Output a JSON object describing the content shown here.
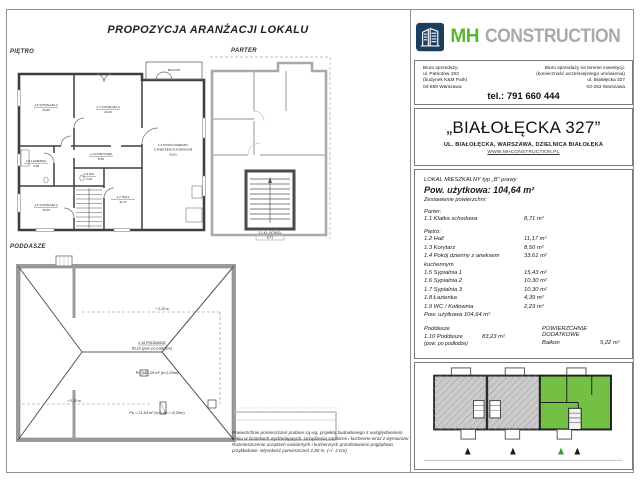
{
  "left": {
    "title": "PROPOZYCJA ARANŻACJI LOKALU",
    "labels": {
      "pietro": "PIĘTRO",
      "parter": "PARTER",
      "poddasze": "PODDASZE"
    },
    "pietro": {
      "balkon": "BALKON",
      "rooms": {
        "syp2": {
          "name": "1.6 SYPIALNIA 2",
          "area": "10,30"
        },
        "syp3": {
          "name": "1.7 SYPIALNIA 3",
          "area": "10,30"
        },
        "living1": "1.4 POKÓJ DZIENNY",
        "living2": "Z ANEKSEM KUCHENNYM",
        "living_area": "33,61",
        "lazienka": {
          "name": "1.8 ŁAZIENKA",
          "area": "4,39"
        },
        "wc": {
          "name": "1.9 WC",
          "area": "2,23"
        },
        "korytarz": {
          "name": "1.3 KORYTARZ",
          "area": "8,50"
        },
        "syp1": {
          "name": "1.5 SYPIALNIA 1",
          "area": "15,43"
        },
        "hall": {
          "name": "1.2 HALL",
          "area": "11,17"
        }
      }
    },
    "parter": {
      "stairs_name": "1.1 KL. SCHOD.",
      "stairs_area": "8,71"
    },
    "poddasze": {
      "name": "1.10 PODDASZE",
      "area": "83,23 (pow. po podłodze)",
      "pu_high": "Pu = 61,29 m² (h>2,20m)",
      "pu_low": "Pu = 21,94 m² (h>1,40 / <2,20m)",
      "height_mark1": "+ 2,20 m",
      "height_mark2": "+ 2,20 m"
    },
    "disclaimer": {
      "l1": "Powierzchnie pomieszczeń podane są wg. projektu budowlanego z uwzględnieniem",
      "l2": "tynku w ściankach wydzielających. Urządzenia sanitarne i kuchenne wraz z wymiarami",
      "l3": "Rozmieszczenie urządzeń sanitarnych i kuchennych przedstawiono poglądowo",
      "l4": "przykładowe. Wysokość pomieszczeń 2,80 m. (+/- 2 cm)"
    }
  },
  "right": {
    "logo": {
      "mh": "MH",
      "construction": "CONSTRUCTION"
    },
    "contact": {
      "office_left": {
        "l1": "Biuro sprzedaży:",
        "l2": "ul. Patriotów 193",
        "l3": "(budynek K&M Park)",
        "l4": "04-858 Warszawa"
      },
      "office_right": {
        "l1": "Biuro sprzedaży na terenie inwestycji:",
        "l2": "(konieczność wcześniejszego umówienia)",
        "l3": "ul. Białołęcka 327",
        "l4": "03-253 Warszawa"
      },
      "phone": "tel.: 791 660 444"
    },
    "title_block": {
      "name": "„BIAŁOŁĘCKA 327”",
      "address": "UL. BIAŁOŁĘCKA, WARSZAWA, DZIELNICA BIAŁOŁĘKA",
      "website": "WWW.MHCONSTRUCTION.PL"
    },
    "details": {
      "type_line": "LOKAL MIESZKALNY typ „B” prawy",
      "area_line": "Pow. użytkowa: 104,64 m²",
      "summary_line": "Zestawienie powierzchni:",
      "parter_header": "Parter:",
      "parter_rooms": [
        {
          "label": "1.1 Klatka schodowa",
          "area": "8,71 m²"
        }
      ],
      "pietro_header": "Piętro:",
      "pietro_rooms": [
        {
          "label": "1.2 Hall",
          "area": "11,17 m²"
        },
        {
          "label": "1.3 Korytarz",
          "area": "8,50 m²"
        },
        {
          "label": "1.4 Pokój dzienny z aneksem kuchennym",
          "area": "33,61 m²"
        },
        {
          "label": "1.5 Sypialnia 1",
          "area": "15,43 m²"
        },
        {
          "label": "1.6 Sypialnia 2",
          "area": "10,30 m²"
        },
        {
          "label": "1.7 Sypialnia 3",
          "area": "10,30 m²"
        },
        {
          "label": "1.8 Łazienka",
          "area": "4,39 m²"
        },
        {
          "label": "1.9 WC / Kotłownia",
          "area": "2,23 m²"
        }
      ],
      "total_line": "Pow. użytkowa 104,64 m²",
      "poddasze_header": "Poddasze",
      "poddasze_room": {
        "label": "1.10 Poddasze",
        "area": "83,23 m²",
        "note": "(pow. po podłodze)"
      },
      "additional_header": "POWIERZCHNIE DODATKOWE",
      "additional_room": {
        "label": "Balkon",
        "area": "5,22 m²"
      }
    }
  },
  "colors": {
    "brand_green": "#56b830",
    "brand_navy": "#1c3e5e",
    "brand_gray": "#a7a9ab",
    "plan_green": "#74c044",
    "plan_gray": "#cbcbcb"
  }
}
